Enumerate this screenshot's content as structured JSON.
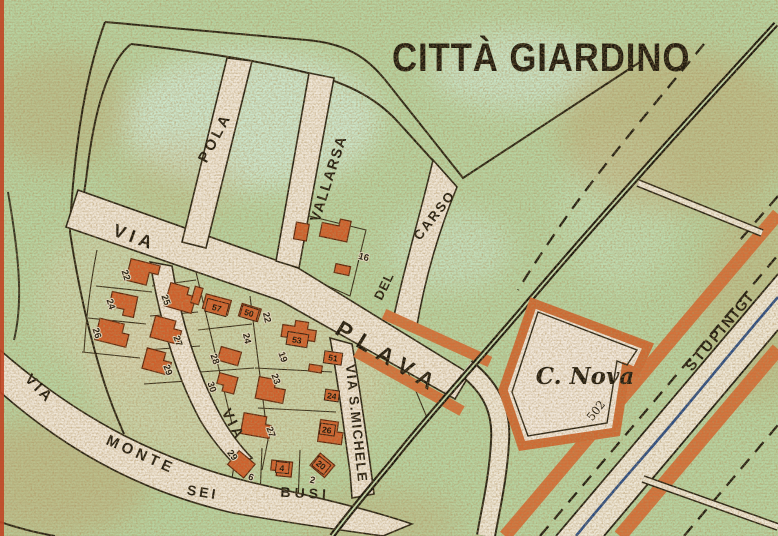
{
  "title": "CITTÀ GIARDINO",
  "streets": {
    "via_nw": "VIA",
    "pola": "POLA",
    "vallarsa": "VALLARSA",
    "del": "DEL",
    "carso": "CARSO",
    "plava": "PLAVA",
    "via_mid": "VIA",
    "s_michele": "VIA S.MICHELE",
    "via_sw": "VIA",
    "monte": "MONTE",
    "sei": "SEI",
    "busi": "BUSI",
    "stupinigi": "STUPINIGI"
  },
  "places": {
    "c_nova": "C. Nova",
    "elevation": "502"
  },
  "lots": {
    "l22a": "22",
    "l24a": "24",
    "l26a": "26",
    "l25": "25",
    "l27a": "27",
    "l29a": "29",
    "l28": "28",
    "l30": "30",
    "l22b": "22",
    "l24b": "24",
    "l19": "19",
    "l23": "23",
    "l27b": "27",
    "l29b": "29",
    "l6": "6",
    "l2": "2",
    "l16": "16"
  },
  "plates": {
    "p57": "57",
    "p50": "50",
    "p53": "53",
    "p51": "51",
    "p24": "24",
    "p26": "26",
    "p4": "4",
    "p20": "20"
  },
  "colors": {
    "paper_green": "#b7d4a2",
    "street_fill": "#f0e7d8",
    "building_orange": "#d05f2b",
    "road_orange": "#d4713a",
    "railway_black": "#16130b",
    "water_blue": "#274b86",
    "page_edge_red": "#c14524"
  }
}
